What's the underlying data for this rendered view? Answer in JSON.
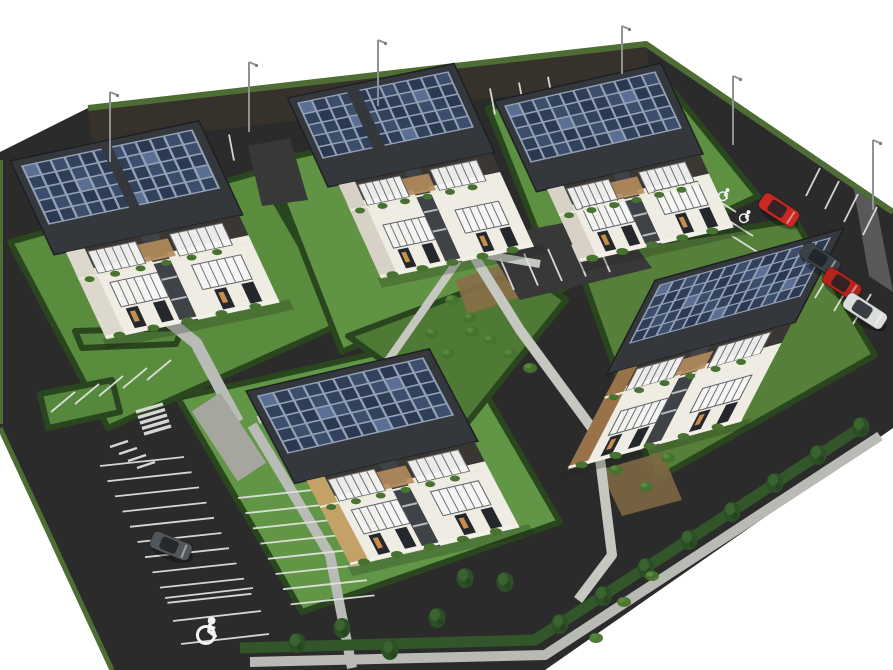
{
  "meta": {
    "type": "3d-architectural-aerial-render",
    "subject": "Aerial 3D rendering of a residential development: five two-storey multi-family houses with rooftop photovoltaic solar arrays, private lawns bordered by hedges, pedestrian walkways, perimeter access roads with marked parking stalls, parked cars and street light poles",
    "canvas_w": 893,
    "canvas_h": 670,
    "background": "#ffffff"
  },
  "palette": {
    "asphalt": "#2b2b2b",
    "asphalt_top_road": "#36312a",
    "asphalt_patch": "#383838",
    "lawn_stroke_hedge": "#2a461f",
    "hedge_band": "#33552a",
    "boundary_hedge": "#4e6d35",
    "path": "#c5c8c1",
    "walk": "#b8bbb4",
    "pebble": "#a5a79f",
    "mark_white": "#e4e4e2",
    "roof_dark": "#34383d",
    "panel_grid": "#93a1b6",
    "panel_cells": [
      "#2b3950",
      "#33425c",
      "#3c4e6b",
      "#2f3d56"
    ],
    "panel_glint": "#5b6f94",
    "wall_white": "#efece4",
    "wall_dark_band": "#3a3733",
    "stair_gap": "#3f4246",
    "pergola": "#f4f5f3",
    "pergola_rib": "#6e7276",
    "wood_deck": "#b58c5c",
    "window_dark": "#24272c",
    "window_warm": "#d89a4e",
    "bush": "#47722f",
    "tree_dark": "#2d4f25",
    "tree_mid": "#3a6330",
    "pole": "#8f9294",
    "symbol_paint": "#f2f2f2"
  },
  "site_outline": [
    [
      88,
      108
    ],
    [
      646,
      44
    ],
    [
      893,
      212
    ],
    [
      893,
      428
    ],
    [
      545,
      670
    ],
    [
      112,
      670
    ],
    [
      0,
      428
    ],
    [
      0,
      152
    ]
  ],
  "top_road_overlay": [
    [
      88,
      108
    ],
    [
      646,
      44
    ],
    [
      650,
      80
    ],
    [
      92,
      144
    ]
  ],
  "glare_patch": [
    [
      850,
      168
    ],
    [
      872,
      183
    ],
    [
      893,
      292
    ],
    [
      869,
      276
    ]
  ],
  "boundary_hedge_top": [
    [
      88,
      108
    ],
    [
      646,
      44
    ],
    [
      893,
      212
    ]
  ],
  "boundary_hedge_left": [
    [
      0,
      428
    ],
    [
      112,
      670
    ]
  ],
  "boundary_hedge_left2": [
    [
      1,
      160
    ],
    [
      1,
      424
    ]
  ],
  "bottom_hedge_line": [
    [
      240,
      648
    ],
    [
      535,
      640
    ],
    [
      866,
      424
    ]
  ],
  "lawns": [
    {
      "name": "parcel-1",
      "pts": [
        [
          10,
          242
        ],
        [
          258,
          172
        ],
        [
          345,
          322
        ],
        [
          108,
          428
        ]
      ],
      "fill": "#5a8c3e"
    },
    {
      "name": "parcel-2",
      "pts": [
        [
          268,
          162
        ],
        [
          462,
          120
        ],
        [
          530,
          266
        ],
        [
          342,
          352
        ]
      ],
      "fill": "#619345"
    },
    {
      "name": "parcel-3",
      "pts": [
        [
          488,
          108
        ],
        [
          656,
          70
        ],
        [
          758,
          196
        ],
        [
          560,
          290
        ]
      ],
      "fill": "#5d9040"
    },
    {
      "name": "parcel-4",
      "pts": [
        [
          575,
          255
        ],
        [
          795,
          220
        ],
        [
          875,
          355
        ],
        [
          655,
          480
        ]
      ],
      "fill": "#567f39"
    },
    {
      "name": "parcel-5",
      "pts": [
        [
          178,
          398
        ],
        [
          452,
          336
        ],
        [
          560,
          522
        ],
        [
          302,
          612
        ]
      ],
      "fill": "#629647"
    },
    {
      "name": "central-green",
      "pts": [
        [
          348,
          336
        ],
        [
          524,
          270
        ],
        [
          566,
          300
        ],
        [
          468,
          422
        ]
      ],
      "fill": "#4f7a35"
    },
    {
      "name": "parking-island-a",
      "pts": [
        [
          75,
          331
        ],
        [
          182,
          328
        ],
        [
          176,
          344
        ],
        [
          82,
          348
        ]
      ],
      "fill": "#55883c"
    },
    {
      "name": "parking-island-b",
      "pts": [
        [
          40,
          394
        ],
        [
          112,
          380
        ],
        [
          120,
          412
        ],
        [
          48,
          428
        ]
      ],
      "fill": "#55883c"
    }
  ],
  "dirt_patches": [
    {
      "pts": [
        [
          600,
          470
        ],
        [
          662,
          452
        ],
        [
          682,
          500
        ],
        [
          622,
          516
        ]
      ],
      "fill": "#7d6742"
    },
    {
      "pts": [
        [
          455,
          280
        ],
        [
          505,
          263
        ],
        [
          518,
          298
        ],
        [
          468,
          314
        ]
      ],
      "fill": "#8a6f48"
    }
  ],
  "asphalt_patches": [
    {
      "name": "parking-court",
      "pts": [
        [
          482,
          238
        ],
        [
          612,
          214
        ],
        [
          652,
          268
        ],
        [
          520,
          300
        ]
      ]
    },
    {
      "name": "driveway",
      "pts": [
        [
          248,
          146
        ],
        [
          290,
          138
        ],
        [
          308,
          200
        ],
        [
          262,
          206
        ]
      ]
    }
  ],
  "paths": [
    {
      "name": "walk-north",
      "pts": [
        [
          452,
          98
        ],
        [
          468,
          238
        ]
      ],
      "w": 9
    },
    {
      "name": "walk-cross",
      "pts": [
        [
          400,
          240
        ],
        [
          540,
          264
        ]
      ],
      "w": 8
    },
    {
      "name": "walk-west",
      "pts": [
        [
          468,
          246
        ],
        [
          380,
          372
        ],
        [
          258,
          420
        ]
      ],
      "w": 8
    },
    {
      "name": "walk-central",
      "pts": [
        [
          470,
          250
        ],
        [
          520,
          330
        ],
        [
          597,
          435
        ],
        [
          612,
          555
        ],
        [
          578,
          600
        ]
      ],
      "w": 10
    },
    {
      "name": "walk-boundary",
      "pts": [
        [
          250,
          662
        ],
        [
          545,
          655
        ],
        [
          880,
          436
        ]
      ],
      "w": 10,
      "c": "#b8bbb4"
    },
    {
      "name": "walk-parking-east",
      "pts": [
        [
          252,
          425
        ],
        [
          330,
          555
        ],
        [
          352,
          668
        ]
      ],
      "w": 10,
      "c": "#b9bcb6"
    },
    {
      "name": "walk-house1",
      "pts": [
        [
          152,
          308
        ],
        [
          196,
          343
        ],
        [
          238,
          422
        ]
      ],
      "w": 12,
      "c": "#b9bcb6"
    },
    {
      "name": "pebble-court",
      "pts": [
        [
          206,
          402
        ],
        [
          252,
          472
        ]
      ],
      "w": 34,
      "c": "#a5a79f"
    }
  ],
  "parking_marks": [
    {
      "name": "top-road-stalls-a",
      "s": [
        142,
        152
      ],
      "st": [
        29,
        -5.8
      ],
      "d": [
        5,
        26
      ],
      "n": 4
    },
    {
      "name": "top-road-stalls-b",
      "s": [
        315,
        120
      ],
      "st": [
        29,
        -5.8
      ],
      "d": [
        5,
        26
      ],
      "n": 4
    },
    {
      "name": "top-road-stalls-c",
      "s": [
        432,
        100
      ],
      "st": [
        29,
        -5.8
      ],
      "d": [
        5,
        26
      ],
      "n": 5
    },
    {
      "name": "right-road-symbol-stalls",
      "s": [
        698,
        188
      ],
      "st": [
        17,
        24
      ],
      "d": [
        38,
        24
      ],
      "n": 3
    },
    {
      "name": "right-road-stalls-upper",
      "s": [
        820,
        168
      ],
      "st": [
        19,
        13
      ],
      "d": [
        -14,
        28
      ],
      "n": 4
    },
    {
      "name": "right-road-stalls-lower",
      "s": [
        795,
        242
      ],
      "st": [
        19,
        13
      ],
      "d": [
        -18,
        30
      ],
      "n": 5
    },
    {
      "name": "west-lot-row-top",
      "s": [
        75,
        392
      ],
      "st": [
        24,
        -8
      ],
      "d": [
        -24,
        20
      ],
      "n": 5
    },
    {
      "name": "west-lot-grid-left",
      "s": [
        100,
        466
      ],
      "st": [
        7.5,
        15.2
      ],
      "d": [
        84,
        -9
      ],
      "n": 10
    },
    {
      "name": "west-lot-grid-right",
      "s": [
        238,
        498
      ],
      "st": [
        7.5,
        15.2
      ],
      "d": [
        84,
        -9
      ],
      "n": 8
    },
    {
      "name": "west-lot-bottom",
      "s": [
        165,
        598
      ],
      "st": [
        8,
        23
      ],
      "d": [
        88,
        -10
      ],
      "n": 3
    },
    {
      "name": "court-stalls",
      "s": [
        500,
        258
      ],
      "st": [
        24,
        -4.5
      ],
      "d": [
        14,
        32
      ],
      "n": 5
    },
    {
      "name": "zebra-crossing",
      "s": [
        136,
        412
      ],
      "st": [
        2,
        5.5
      ],
      "d": [
        27,
        -8
      ],
      "n": 5,
      "w": 3.5
    },
    {
      "name": "hatch-marking",
      "s": [
        110,
        447
      ],
      "st": [
        9,
        7
      ],
      "d": [
        18,
        -6
      ],
      "n": 4,
      "w": 2.5
    }
  ],
  "buildings": [
    {
      "id": 1,
      "o": [
        22,
        166
      ],
      "u": [
        170,
        -36
      ],
      "v": [
        27,
        58
      ],
      "cols": 12,
      "rows": 5,
      "depth": 3.0,
      "accent": "#ddd8cc",
      "split": [
        0.47,
        0.53
      ]
    },
    {
      "id": 2,
      "o": [
        298,
        103
      ],
      "u": [
        150,
        -31
      ],
      "v": [
        25,
        55
      ],
      "cols": 11,
      "rows": 5,
      "depth": 3.2,
      "accent": "#d8d2c6",
      "split": [
        0.33,
        0.41
      ]
    },
    {
      "id": 3,
      "o": [
        505,
        106
      ],
      "u": [
        150,
        -34
      ],
      "v": [
        26,
        56
      ],
      "cols": 11,
      "rows": 5,
      "depth": 2.8,
      "accent": "#d8d2c6",
      "split": null
    },
    {
      "id": 4,
      "o": [
        660,
        285
      ],
      "u": [
        170,
        -47
      ],
      "v": [
        -30,
        58
      ],
      "cols": 13,
      "rows": 5,
      "depth": 3.2,
      "accent": "#9a7248",
      "split": null
    },
    {
      "id": 5,
      "o": [
        258,
        396
      ],
      "u": [
        165,
        -38
      ],
      "v": [
        30,
        57
      ],
      "cols": 11,
      "rows": 5,
      "depth": 3.0,
      "accent": "#c4a267",
      "split": null
    }
  ],
  "cars": [
    {
      "name": "car-red-1",
      "fill": "#c62a22",
      "x": 779,
      "y": 210,
      "rot": 33,
      "len": 42
    },
    {
      "name": "car-dark-suv",
      "fill": "#3a4248",
      "x": 820,
      "y": 259,
      "rot": 33,
      "len": 42
    },
    {
      "name": "car-red-2",
      "fill": "#b5231c",
      "x": 842,
      "y": 284,
      "rot": 33,
      "len": 40
    },
    {
      "name": "car-white-van",
      "fill": "#dcdedd",
      "x": 865,
      "y": 311,
      "rot": 33,
      "len": 46
    },
    {
      "name": "car-gray-parked",
      "fill": "#51565a",
      "x": 171,
      "y": 546,
      "rot": 22,
      "len": 42
    }
  ],
  "poles": [
    {
      "x": 110,
      "top": 92,
      "bottom": 162
    },
    {
      "x": 249,
      "top": 62,
      "bottom": 132
    },
    {
      "x": 378,
      "top": 40,
      "bottom": 106
    },
    {
      "x": 622,
      "top": 26,
      "bottom": 74
    },
    {
      "x": 733,
      "top": 76,
      "bottom": 145
    },
    {
      "x": 873,
      "top": 140,
      "bottom": 210
    }
  ],
  "accessibility_symbols": [
    {
      "name": "handicap-stall-symbol",
      "x": 207,
      "y": 630,
      "s": 1.7,
      "rot": 12
    },
    {
      "name": "reserved-stall-symbol-1",
      "x": 724,
      "y": 194,
      "s": 0.85,
      "rot": 28
    },
    {
      "name": "reserved-stall-symbol-2",
      "x": 745,
      "y": 216,
      "s": 0.85,
      "rot": 28
    }
  ],
  "trees": [
    [
      560,
      624
    ],
    [
      603,
      596
    ],
    [
      646,
      568
    ],
    [
      689,
      540
    ],
    [
      732,
      512
    ],
    [
      775,
      483
    ],
    [
      818,
      455
    ],
    [
      861,
      427
    ],
    [
      297,
      643
    ],
    [
      342,
      628
    ],
    [
      390,
      650
    ],
    [
      437,
      618
    ],
    [
      465,
      578
    ],
    [
      505,
      582
    ]
  ],
  "bushes": [
    [
      452,
      300
    ],
    [
      470,
      318
    ],
    [
      432,
      333
    ],
    [
      490,
      340
    ],
    [
      510,
      354
    ],
    [
      448,
      354
    ],
    [
      616,
      470
    ],
    [
      646,
      487
    ],
    [
      668,
      458
    ],
    [
      596,
      638
    ],
    [
      624,
      602
    ],
    [
      652,
      576
    ],
    [
      472,
      332
    ],
    [
      530,
      368
    ]
  ]
}
